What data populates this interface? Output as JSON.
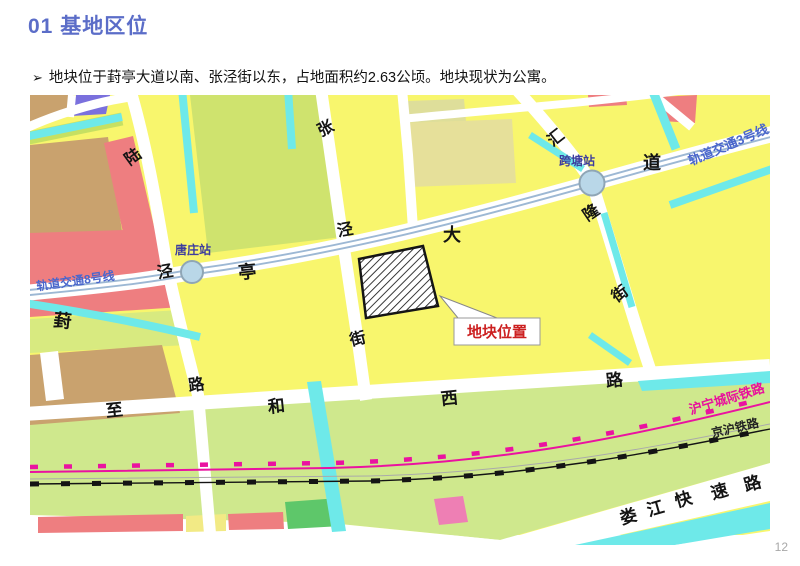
{
  "slide": {
    "title": "01 基地区位",
    "bullet_marker": "➢",
    "bullet_text": "地块位于葑亭大道以南、张泾街以东，占地面积约2.63公顷。地块现状为公寓。",
    "page_number": "12"
  },
  "colors": {
    "title_blue": "#5b6dc8",
    "plot_label_red": "#cc2020",
    "metro_label_blue": "#4a66cc",
    "railway_magenta": "#e8109c"
  },
  "map": {
    "plot_label": "地块位置",
    "stations": {
      "tangzhuang": "唐庄站",
      "kuatang": "跨塘站"
    },
    "metro_lines": {
      "line3": "轨道交通3号线",
      "line8": "轨道交通8号线"
    },
    "railways": {
      "huning": "沪宁城际铁路",
      "jinghu": "京沪铁路"
    },
    "roads": {
      "fengting_avenue": {
        "chars": [
          "葑",
          "亭",
          "大",
          "道"
        ]
      },
      "lujing_road": {
        "chars": [
          "陆",
          "泾",
          "路"
        ]
      },
      "zhangjing_street": {
        "chars": [
          "张",
          "泾",
          "街"
        ]
      },
      "huilong_street": {
        "chars": [
          "汇",
          "隆",
          "街"
        ]
      },
      "zhihe_west_road": {
        "chars": [
          "至",
          "和",
          "西",
          "路"
        ]
      },
      "loujiang_expressway": {
        "chars": [
          "娄",
          "江",
          "快",
          "速",
          "路"
        ]
      }
    }
  }
}
